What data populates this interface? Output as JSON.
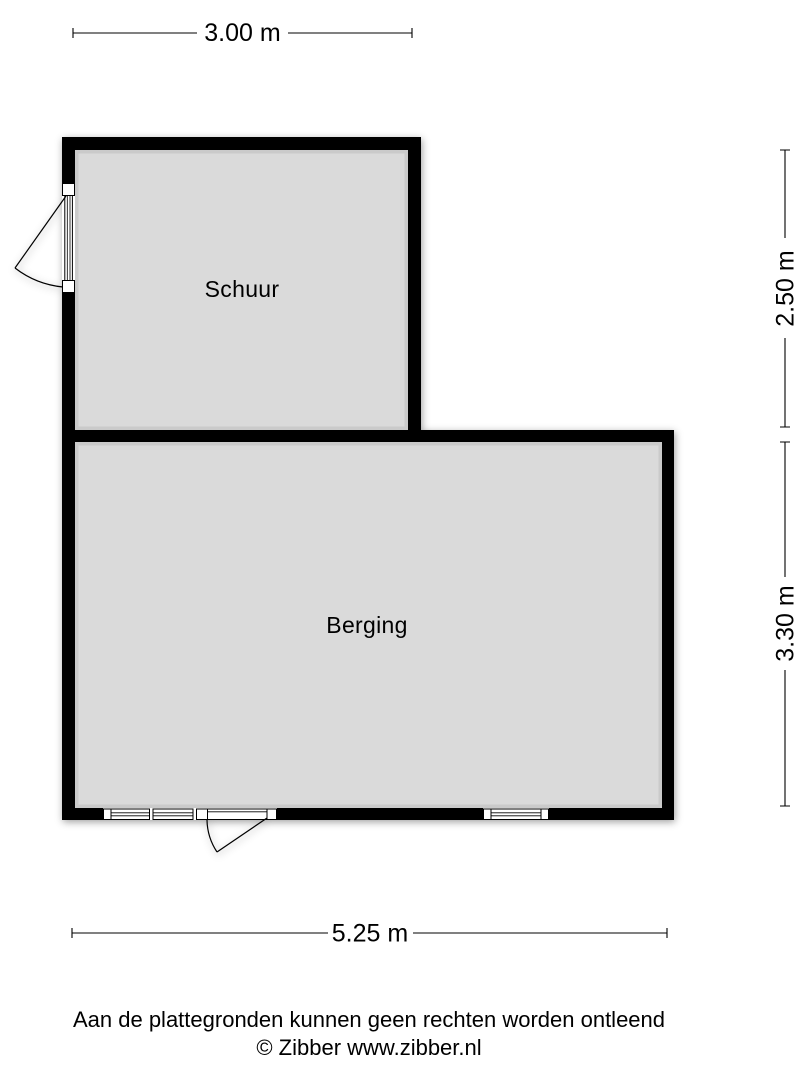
{
  "floorplan": {
    "rooms": [
      {
        "name": "Schuur"
      },
      {
        "name": "Berging"
      }
    ],
    "dimensions": {
      "top": {
        "label": "3.00 m"
      },
      "right_upper": {
        "label": "2.50 m"
      },
      "right_lower": {
        "label": "3.30 m"
      },
      "bottom": {
        "label": "5.25 m"
      }
    },
    "colors": {
      "wall": "#000000",
      "floor": "#dadada",
      "background": "#ffffff",
      "text": "#000000"
    }
  },
  "footer": {
    "disclaimer": "Aan de plattegronden kunnen geen rechten worden ontleend",
    "copyright": "© Zibber www.zibber.nl"
  }
}
